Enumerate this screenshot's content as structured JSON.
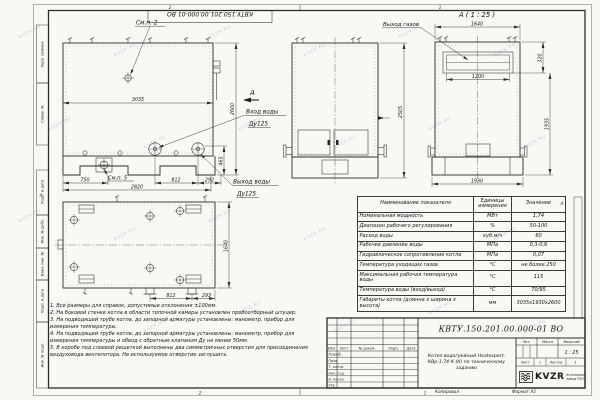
{
  "sheet": {
    "watermark": "KVZR.RU",
    "stamp_top": "КВТУ.150.201.00.000-01 ВО",
    "zones": {
      "top_left": "2",
      "top_right": "1",
      "bottom_left": "2",
      "bottom_right": "1",
      "side_left": "А",
      "side_right": "А"
    },
    "bottom_labels": {
      "copied": "Копировал",
      "format": "Формат А3"
    }
  },
  "margin_labels": [
    "Перв. примен.",
    "Справ. №",
    "Подп. и дата",
    "Инв. № дубл.",
    "Взам. инв. №",
    "Подп. и дата",
    "Инв. № подл."
  ],
  "views": {
    "side": {
      "callout_top": "См.п. 2",
      "callout_bottom": "См.п. 5",
      "water_inlet": {
        "line1": "Вход воды",
        "line2": "Ду125"
      },
      "water_outlet": {
        "line1": "Выход воды",
        "line2": "Ду125"
      },
      "section_mark": "А",
      "dims": {
        "width": "3035",
        "height": "2600",
        "foot": "750",
        "base": "2820",
        "flange_span": "812",
        "edge": "292",
        "support_height": "465"
      }
    },
    "front": {
      "dims": {
        "height": "2505"
      }
    },
    "back": {
      "label": "А ( 1 : 25 )",
      "gas_outlet": "Выход газов",
      "dims": {
        "top_width": "1640",
        "opening_width": "1200",
        "opening_height": "320",
        "body_height": "1935",
        "base_width": "1930"
      }
    },
    "plan": {
      "dims": {
        "depth": "1640",
        "flange_span": "812",
        "edge": "293"
      }
    }
  },
  "spec_table": {
    "headers": [
      "Наименование показателя",
      "Единицы измерения",
      "Значение"
    ],
    "rows": [
      {
        "name": "Номинальная мощность",
        "units": "МВт",
        "value": "1,74"
      },
      {
        "name": "Диапазон рабочего регулирования",
        "units": "%",
        "value": "50-100"
      },
      {
        "name": "Расход воды",
        "units": "куб.м/ч",
        "value": "60"
      },
      {
        "name": "Рабочее давление воды",
        "units": "МПа",
        "value": "0,3-0,6"
      },
      {
        "name": "Гидравлическое сопротивление котла",
        "units": "МПа",
        "value": "0,07"
      },
      {
        "name": "Температура уходящих газов",
        "units": "°С",
        "value": "не более 250"
      },
      {
        "name": "Максимальная рабочая температура воды",
        "units": "°С",
        "value": "115"
      },
      {
        "name": "Температура воды (вход/выход)",
        "units": "°С",
        "value": "70/95"
      },
      {
        "name": "Габариты котла (длинна х ширина х высота)",
        "units": "мм",
        "value": "3035х1930х2600"
      }
    ]
  },
  "notes": [
    "1. Все размеры для справок, допустимые отклонения ±100мм.",
    "2. На боковой стенке котла в области топочной камеры установлен пробоотборный штуцер.",
    "3. На подводящей трубе котла, до запорной арматуры установлены: манометр, прибор для измерения температуры.",
    "4. На подводящей трубе котла, до запорной арматуры установлены: манометр, прибор для измерения температуры и обвод с обратным клапаном Ду не менее 50мм.",
    "5. В коробе под слоевой решеткой выполнены два симметричных отверстия для присоединения воздуховода вентилятора. Не используемое отверстие заглушить."
  ],
  "title_block": {
    "doc_number": "КВТУ.150.201.00.000-01 ВО",
    "description": "Котел водогрейный Heatexpert-КВр-1,74-К (К) по техническому заданию",
    "header_cols": [
      "Изм.",
      "Лист",
      "№ докум.",
      "Подп.",
      "Дата"
    ],
    "row_labels": [
      "Разраб.",
      "Пров.",
      "Т. контр.",
      "Нач. отд.",
      "Н. контр.",
      "Утв."
    ],
    "lit": "Лит.",
    "mass": "Масса",
    "scale": "Масштаб",
    "scale_value": "1 : 25",
    "sheet": "Лист",
    "sheet_value": "1",
    "sheets": "Листов",
    "sheets_value": "1",
    "logo_text": "KVZR",
    "logo_caption": "Котельный завод РЭП"
  }
}
